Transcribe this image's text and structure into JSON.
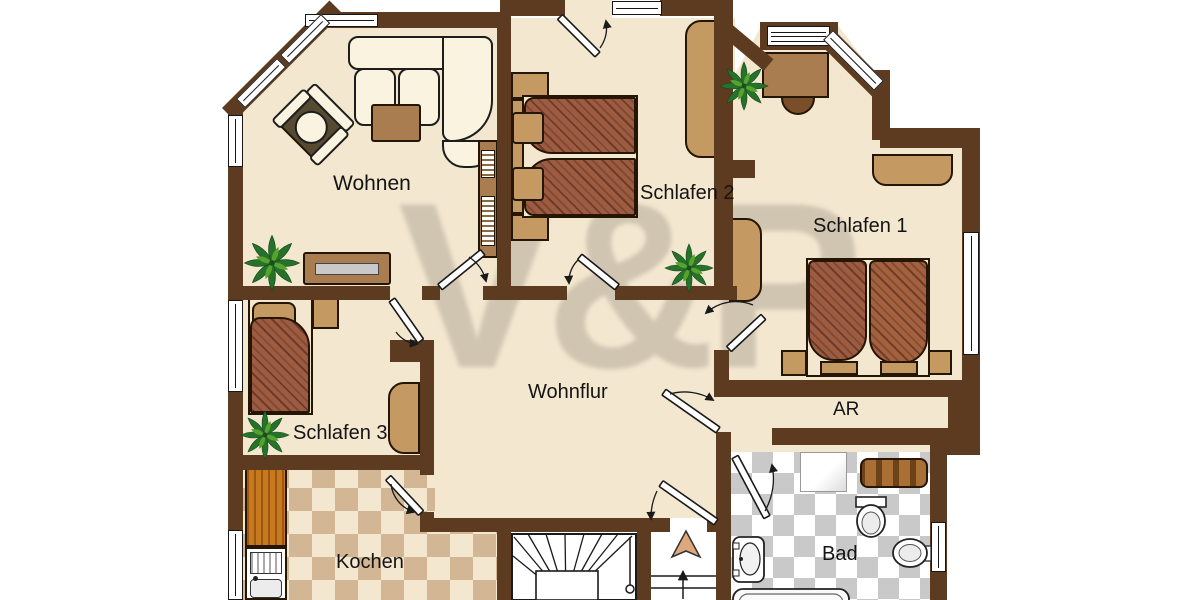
{
  "watermark": {
    "text": "V&P"
  },
  "rooms": {
    "wohnen": {
      "label": "Wohnen"
    },
    "schlafen2": {
      "label": "Schlafen 2"
    },
    "schlafen1": {
      "label": "Schlafen 1"
    },
    "schlafen3": {
      "label": "Schlafen 3"
    },
    "wohnflur": {
      "label": "Wohnflur"
    },
    "ar": {
      "label": "AR"
    },
    "kochen": {
      "label": "Kochen"
    },
    "bad": {
      "label": "Bad"
    }
  },
  "colors": {
    "wall": "#5d3b20",
    "floor_cream": "#f3e7cf",
    "kitchen_tile": "#d3b694",
    "bath_tile": "#c9c9c9",
    "furniture_tan": "#c59a62",
    "furniture_brown": "#aa7d50",
    "bed_duvet": "#9d5c42",
    "wood_counter": "#c8791e",
    "plant_green": "#26722a",
    "label_text": "#141414",
    "watermark_gray": "#8d857a"
  }
}
